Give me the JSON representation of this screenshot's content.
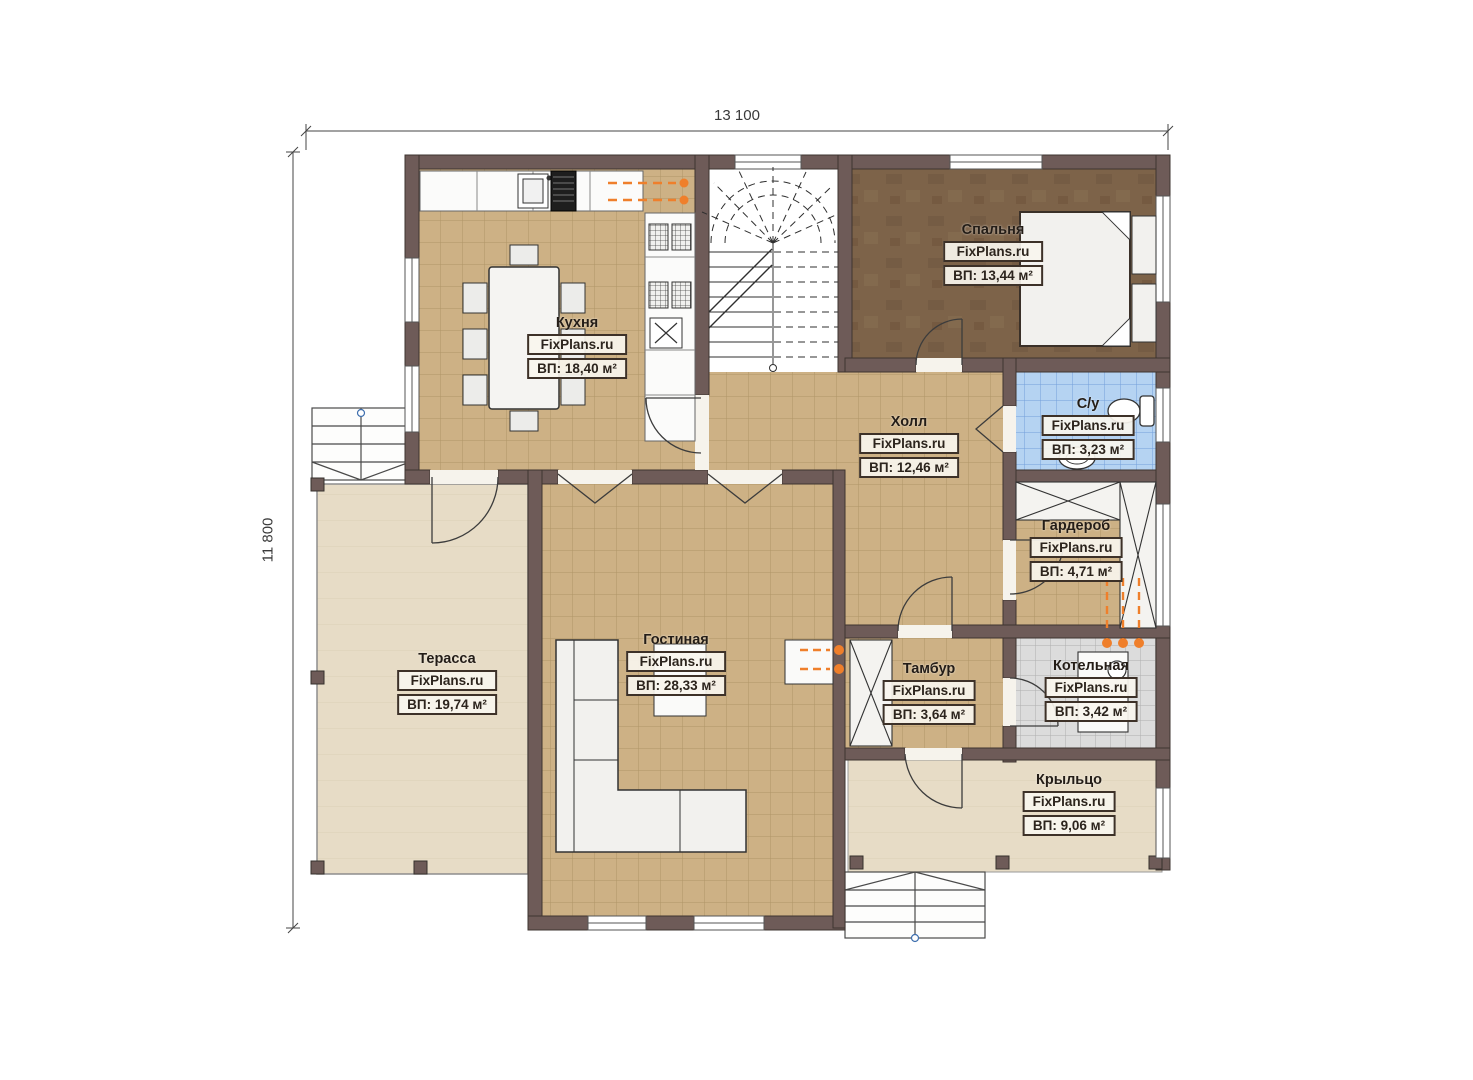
{
  "watermark": "FixPlans.ru",
  "dimensions": {
    "width_label": "13 100",
    "height_label": "11 800"
  },
  "rooms": [
    {
      "id": "kitchen",
      "name": "Кухня",
      "area": "ВП: 18,40 м²"
    },
    {
      "id": "bedroom",
      "name": "Спальня",
      "area": "ВП: 13,44 м²"
    },
    {
      "id": "hall",
      "name": "Холл",
      "area": "ВП: 12,46 м²"
    },
    {
      "id": "bathroom",
      "name": "С/у",
      "area": "ВП: 3,23 м²"
    },
    {
      "id": "wardrobe",
      "name": "Гардероб",
      "area": "ВП: 4,71 м²"
    },
    {
      "id": "terrace",
      "name": "Терасса",
      "area": "ВП: 19,74 м²"
    },
    {
      "id": "living",
      "name": "Гостиная",
      "area": "ВП: 28,33 м²"
    },
    {
      "id": "vestibule",
      "name": "Тамбур",
      "area": "ВП: 3,64 м²"
    },
    {
      "id": "boiler",
      "name": "Котельная",
      "area": "ВП: 3,42 м²"
    },
    {
      "id": "porch",
      "name": "Крыльцо",
      "area": "ВП: 9,06 м²"
    }
  ],
  "colors": {
    "wall": "#6e5b58",
    "floor_tile": "#cdb185",
    "bedroom_floor": "#7d6349",
    "bathroom_floor": "#b5d3f2",
    "boiler_floor": "#dcdcdc",
    "terrace_floor": "#e7dcc6",
    "label_border": "#3d3128",
    "radiator": "#ef7f2b"
  }
}
